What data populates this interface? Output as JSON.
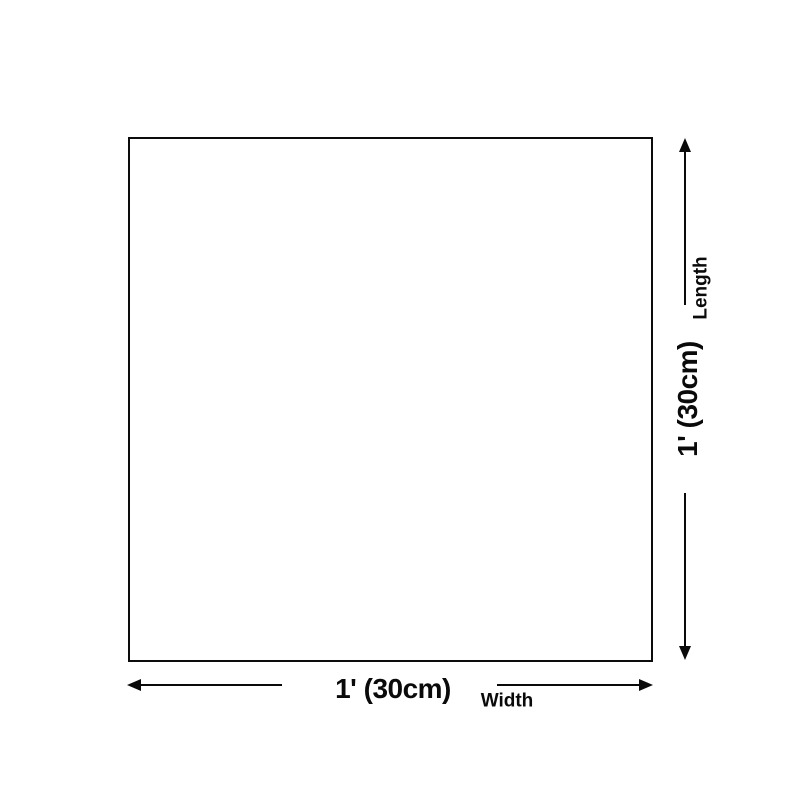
{
  "diagram": {
    "type": "size-dimension-diagram",
    "background_color": "#ffffff",
    "line_color": "#0a0a0a",
    "shape": {
      "kind": "square-outline",
      "border_color": "#0c0c0c"
    },
    "vertical_dimension": {
      "label": "Length",
      "value": "1' (30cm)"
    },
    "horizontal_dimension": {
      "label": "Width",
      "value": "1' (30cm)"
    }
  }
}
